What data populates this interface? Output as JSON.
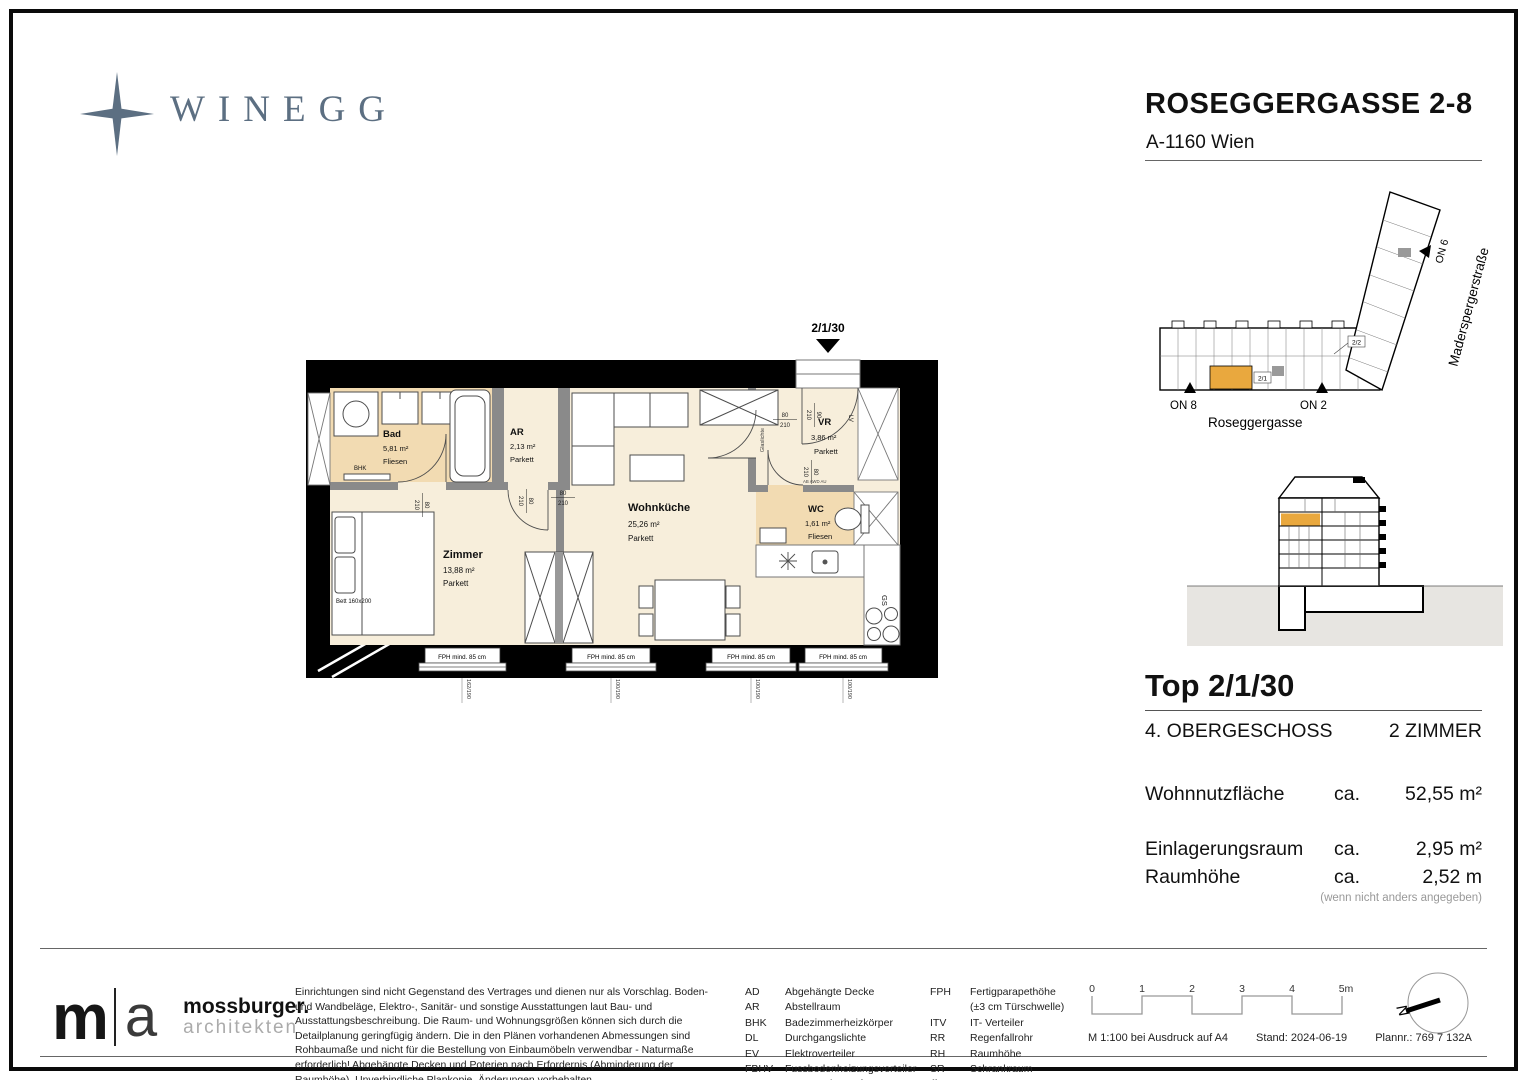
{
  "header": {
    "brand": "WINEGG",
    "title": "ROSEGGERGASSE 2-8",
    "address": "A-1160 Wien"
  },
  "floorplan": {
    "unit_marker": "2/1/30",
    "rooms": {
      "bad": {
        "name": "Bad",
        "area": "5,81 m²",
        "floor": "Fliesen"
      },
      "ar": {
        "name": "AR",
        "area": "2,13 m²",
        "floor": "Parkett"
      },
      "zimmer": {
        "name": "Zimmer",
        "area": "13,88 m²",
        "floor": "Parkett"
      },
      "wohnkueche": {
        "name": "Wohnküche",
        "area": "25,26 m²",
        "floor": "Parkett"
      },
      "vr": {
        "name": "VR",
        "area": "3,86 m²",
        "floor": "Parkett"
      },
      "wc": {
        "name": "WC",
        "area": "1,61 m²",
        "floor": "Fliesen"
      }
    },
    "labels": {
      "bhk": "BHK",
      "bett": "Bett 160x200",
      "gs": "GS",
      "lv": "LV",
      "glaslichte": "Glaslichte",
      "shaft": "AB AWD AU",
      "fph": "FPH mind. 85 cm"
    },
    "dims": {
      "d80": "80",
      "d90": "90",
      "d210": "210",
      "win_zimmer": "162/190",
      "win_std": "100/190"
    }
  },
  "siteplan": {
    "street_bottom": "Roseggergasse",
    "street_right": "Maderspergerstraße",
    "on8": "ON 8",
    "on2": "ON 2",
    "on6": "ON 6",
    "unit1": "2/1",
    "unit2": "2/2"
  },
  "info": {
    "title": "Top 2/1/30",
    "floor": "4. OBERGESCHOSS",
    "rooms": "2 ZIMMER",
    "metrics": [
      {
        "label": "Wohnnutzfläche",
        "approx": "ca.",
        "value": "52,55 m²"
      },
      {
        "label": "Einlagerungsraum",
        "approx": "ca.",
        "value": "2,95 m²"
      },
      {
        "label": "Raumhöhe",
        "approx": "ca.",
        "value": "2,52 m"
      }
    ],
    "note": "(wenn nicht anders angegeben)"
  },
  "footer": {
    "architect": {
      "m": "m",
      "a": "a",
      "name": "mossburger.",
      "sub": "architekten"
    },
    "disclaimer": "Einrichtungen sind nicht Gegenstand des Vertrages und dienen nur als Vorschlag. Boden- und Wandbeläge, Elektro-, Sanitär- und sonstige Ausstattungen laut Bau- und Ausstattungsbeschreibung. Die Raum- und Wohnungsgrößen können sich durch die Detailplanung geringfügig ändern. Die in den Plänen vorhandenen Abmessungen sind Rohbaumaße und nicht für die Bestellung von Einbaumöbeln verwendbar - Naturmaße erforderlich! Abgehängte Decken und Poterien nach Erfordernis (Abminderung der Raumhöhe). Unverbindliche Plankopie, Änderungen vorbehalten.",
    "legend_col1": [
      [
        "AD",
        "Abgehängte Decke"
      ],
      [
        "AR",
        "Abstellraum"
      ],
      [
        "BHK",
        "Badezimmerheizkörper"
      ],
      [
        "DL",
        "Durchgangslichte"
      ],
      [
        "EV",
        "Elektroverteiler"
      ],
      [
        "FBHV",
        "Fussbodenheizungsverteiler"
      ],
      [
        "LV",
        "Leerverrohrung für autom. Türoffner"
      ]
    ],
    "legend_col2": [
      [
        "FPH",
        "Fertigparapethöhe"
      ],
      [
        "",
        "(±3 cm Türschwelle)"
      ],
      [
        "ITV",
        "IT- Verteiler"
      ],
      [
        "RR",
        "Regenfallrohr"
      ],
      [
        "RH",
        "Raumhöhe"
      ],
      [
        "SR",
        "Schrankraum"
      ],
      [
        "VR",
        "Vorraum"
      ]
    ],
    "scale_ticks": [
      "0",
      "1",
      "2",
      "3",
      "4",
      "5m"
    ],
    "print_info": [
      "M 1:100 bei Ausdruck auf A4",
      "Stand: 2024-06-19",
      "Plannr.: 769 7 132A"
    ],
    "north": "N"
  },
  "colors": {
    "brand": "#5c6f82",
    "floor_main": "#f7eedb",
    "floor_tile": "#f2dbb2",
    "highlight": "#e9a83e",
    "wall": "#000000",
    "partition": "#8a8a8a",
    "ground": "#e7e5e1"
  }
}
